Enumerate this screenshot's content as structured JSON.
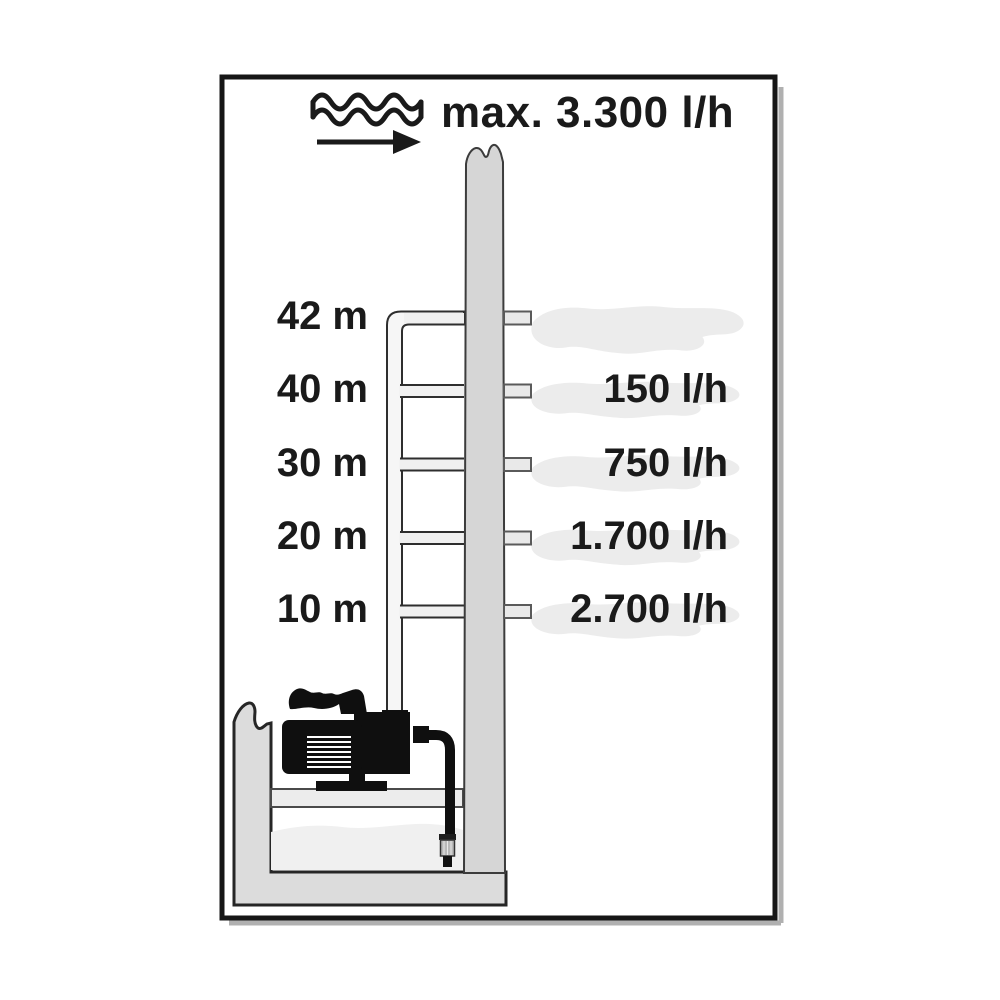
{
  "palette": {
    "ink": "#1a1a1a",
    "concrete_gray": "#d6d6d6",
    "basin_gray": "#dcdcdc",
    "pipe_fill": "#f6f6f6",
    "branch_fill": "#f0f0f0",
    "outlet_fill": "#e9e9e9",
    "splash_gray": "#ececec",
    "water_gray": "#f0f0f0",
    "pump_black": "#0f0f0f",
    "frame_shadow": "#b0b0b0"
  },
  "header": {
    "max_flow_label": "max. 3.300 l/h"
  },
  "levels": [
    {
      "height": "42 m",
      "flow": ""
    },
    {
      "height": "40 m",
      "flow": "150 l/h"
    },
    {
      "height": "30 m",
      "flow": "750 l/h"
    },
    {
      "height": "20 m",
      "flow": "1.700 l/h"
    },
    {
      "height": "10 m",
      "flow": "2.700 l/h"
    }
  ],
  "chart_data": {
    "type": "table",
    "title": "max. 3.300 l/h",
    "categories": [
      "max",
      "10 m",
      "20 m",
      "30 m",
      "40 m",
      "42 m"
    ],
    "values": [
      3300,
      2700,
      1700,
      750,
      150,
      0
    ],
    "xlabel": "delivery height (m)",
    "ylabel": "delivery rate (l/h)"
  }
}
